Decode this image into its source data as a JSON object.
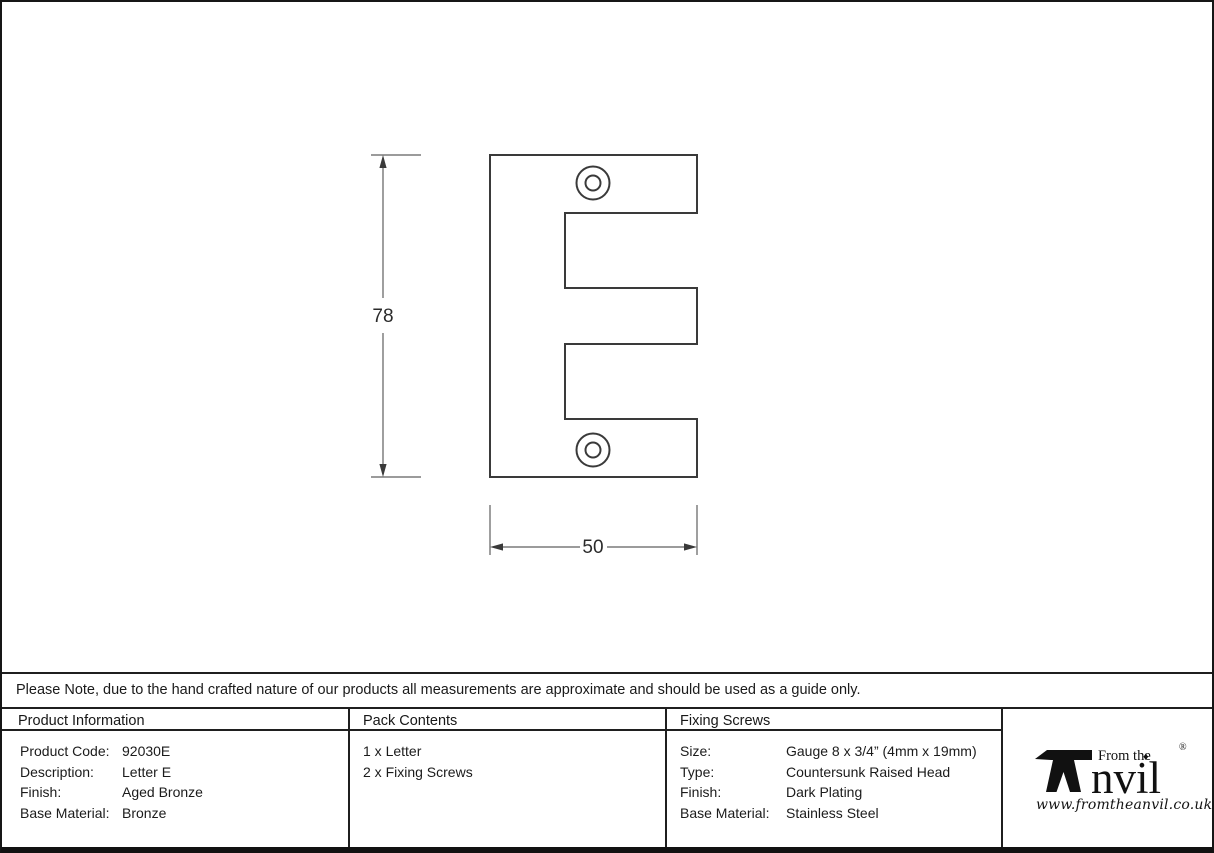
{
  "drawing": {
    "letter": "E",
    "height_dim": "78",
    "width_dim": "50"
  },
  "note": "Please Note, due to the hand crafted nature of our products all measurements are approximate and should be used as a guide only.",
  "table": {
    "product_information": {
      "header": "Product Information",
      "rows": [
        {
          "label": "Product Code:",
          "value": "92030E"
        },
        {
          "label": "Description:",
          "value": "Letter E"
        },
        {
          "label": "Finish:",
          "value": "Aged Bronze"
        },
        {
          "label": "Base Material:",
          "value": "Bronze"
        }
      ]
    },
    "pack_contents": {
      "header": "Pack Contents",
      "items": [
        "1 x Letter",
        "2 x Fixing Screws"
      ]
    },
    "fixing_screws": {
      "header": "Fixing Screws",
      "rows": [
        {
          "label": "Size:",
          "value": "Gauge 8 x 3/4” (4mm x 19mm)"
        },
        {
          "label": "Type:",
          "value": "Countersunk Raised Head"
        },
        {
          "label": "Finish:",
          "value": "Dark Plating"
        },
        {
          "label": "Base Material:",
          "value": "Stainless Steel"
        }
      ]
    }
  },
  "logo": {
    "prefix": "From the",
    "suffix": "nvil",
    "diamond": "♦",
    "registered": "®",
    "url": "www.fromtheanvil.co.uk"
  },
  "colors": {
    "background": "#ffffff",
    "ink": "#1c1c1c",
    "outline": "#3a3a3a",
    "dimension_line": "#5f5f5f"
  }
}
